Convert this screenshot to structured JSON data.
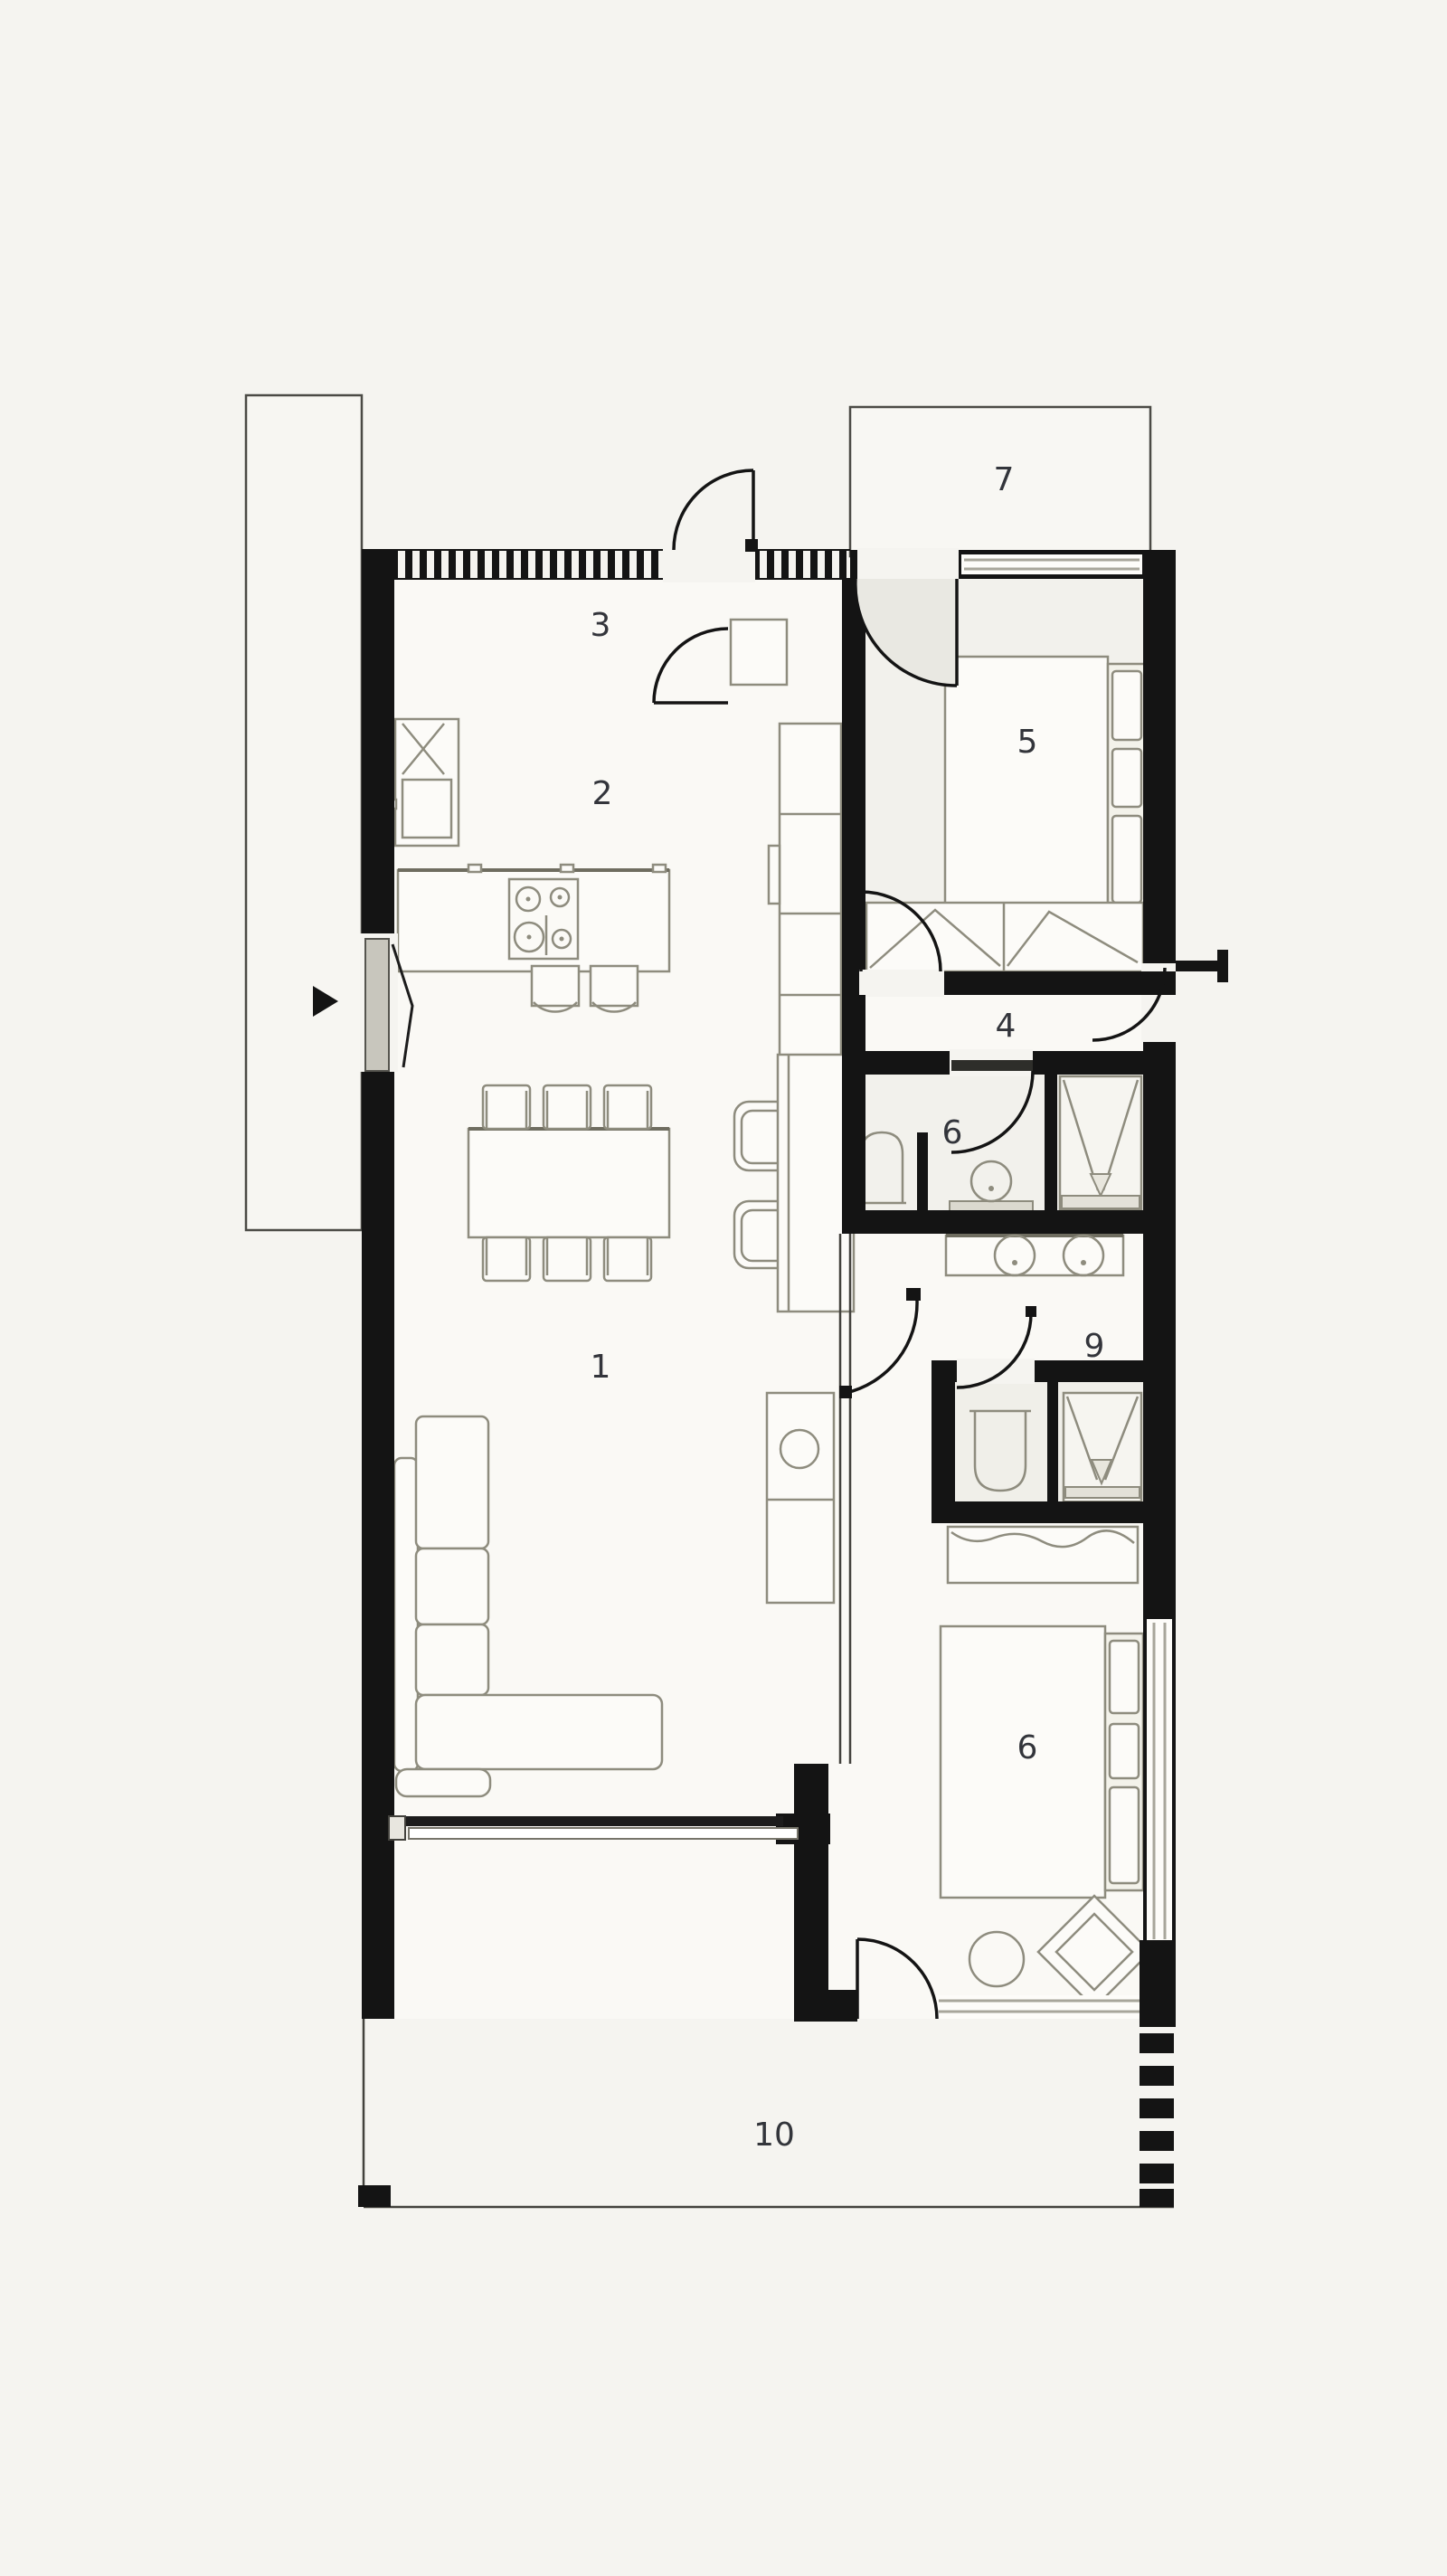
{
  "page": {
    "background": "#f5f4f0"
  },
  "plan": {
    "type": "architectural-floor-plan",
    "colors": {
      "wall": "#141414",
      "thin_line": "#43423d",
      "furniture_stroke": "#8e8c7e",
      "furniture_fill": "#fcfbf8",
      "glass": "#a8a69b",
      "label": "#33353b",
      "interior": "#faf9f5",
      "room_tint": "#f2f1ec",
      "door_swing": "#e9e8e2"
    },
    "rooms": [
      {
        "id": "living-dining",
        "number": "1"
      },
      {
        "id": "kitchen",
        "number": "2"
      },
      {
        "id": "entry-hall",
        "number": "3"
      },
      {
        "id": "hallway",
        "number": "4"
      },
      {
        "id": "bedroom-main",
        "number": "5"
      },
      {
        "id": "bathroom",
        "number": "6"
      },
      {
        "id": "terrace-upper",
        "number": "7"
      },
      {
        "id": "ensuite-bathroom",
        "number": "9"
      },
      {
        "id": "bedroom-second",
        "number": "6"
      },
      {
        "id": "terrace-lower",
        "number": "10"
      }
    ]
  }
}
